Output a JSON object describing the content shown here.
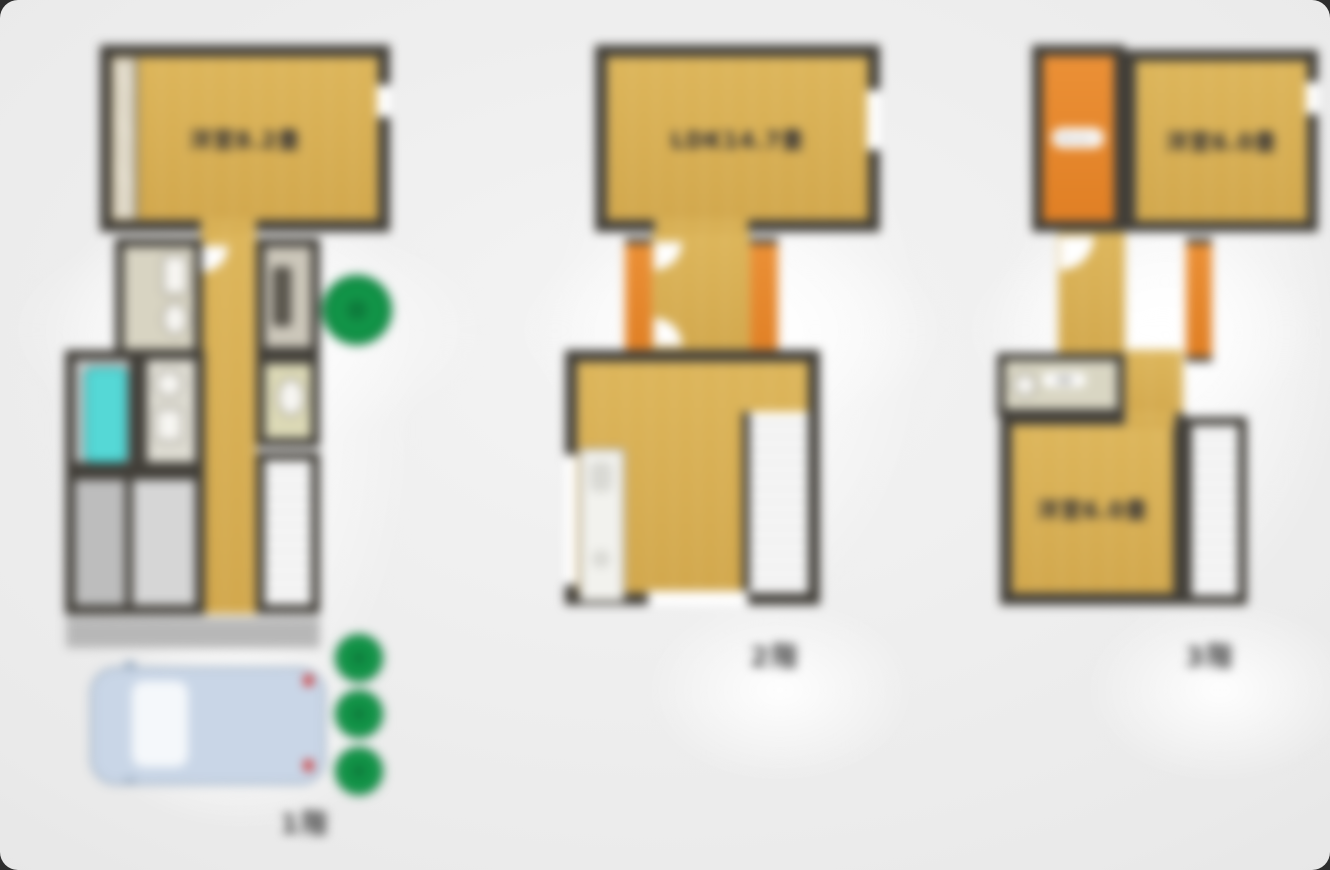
{
  "floors": [
    {
      "id": "1f",
      "floor_label": "1階",
      "main_room_label": "洋室8.2畳"
    },
    {
      "id": "2f",
      "floor_label": "2階",
      "main_room_label": "LDK14.7畳"
    },
    {
      "id": "3f",
      "floor_label": "3階",
      "room_a_label": "洋室6.0畳",
      "room_b_label": "洋室6.0畳",
      "balcony_label": "バルコニー",
      "washroom_label": "洗面"
    }
  ],
  "colors": {
    "wall": "#413e38",
    "floor_yellow": "#d8af54",
    "balcony_orange": "#e8882c",
    "bathtub_cyan": "#55d8d6",
    "greenery_green": "#119a4c",
    "car_body_blue": "#c9d6e7",
    "background_gray": "#eaeaea"
  }
}
